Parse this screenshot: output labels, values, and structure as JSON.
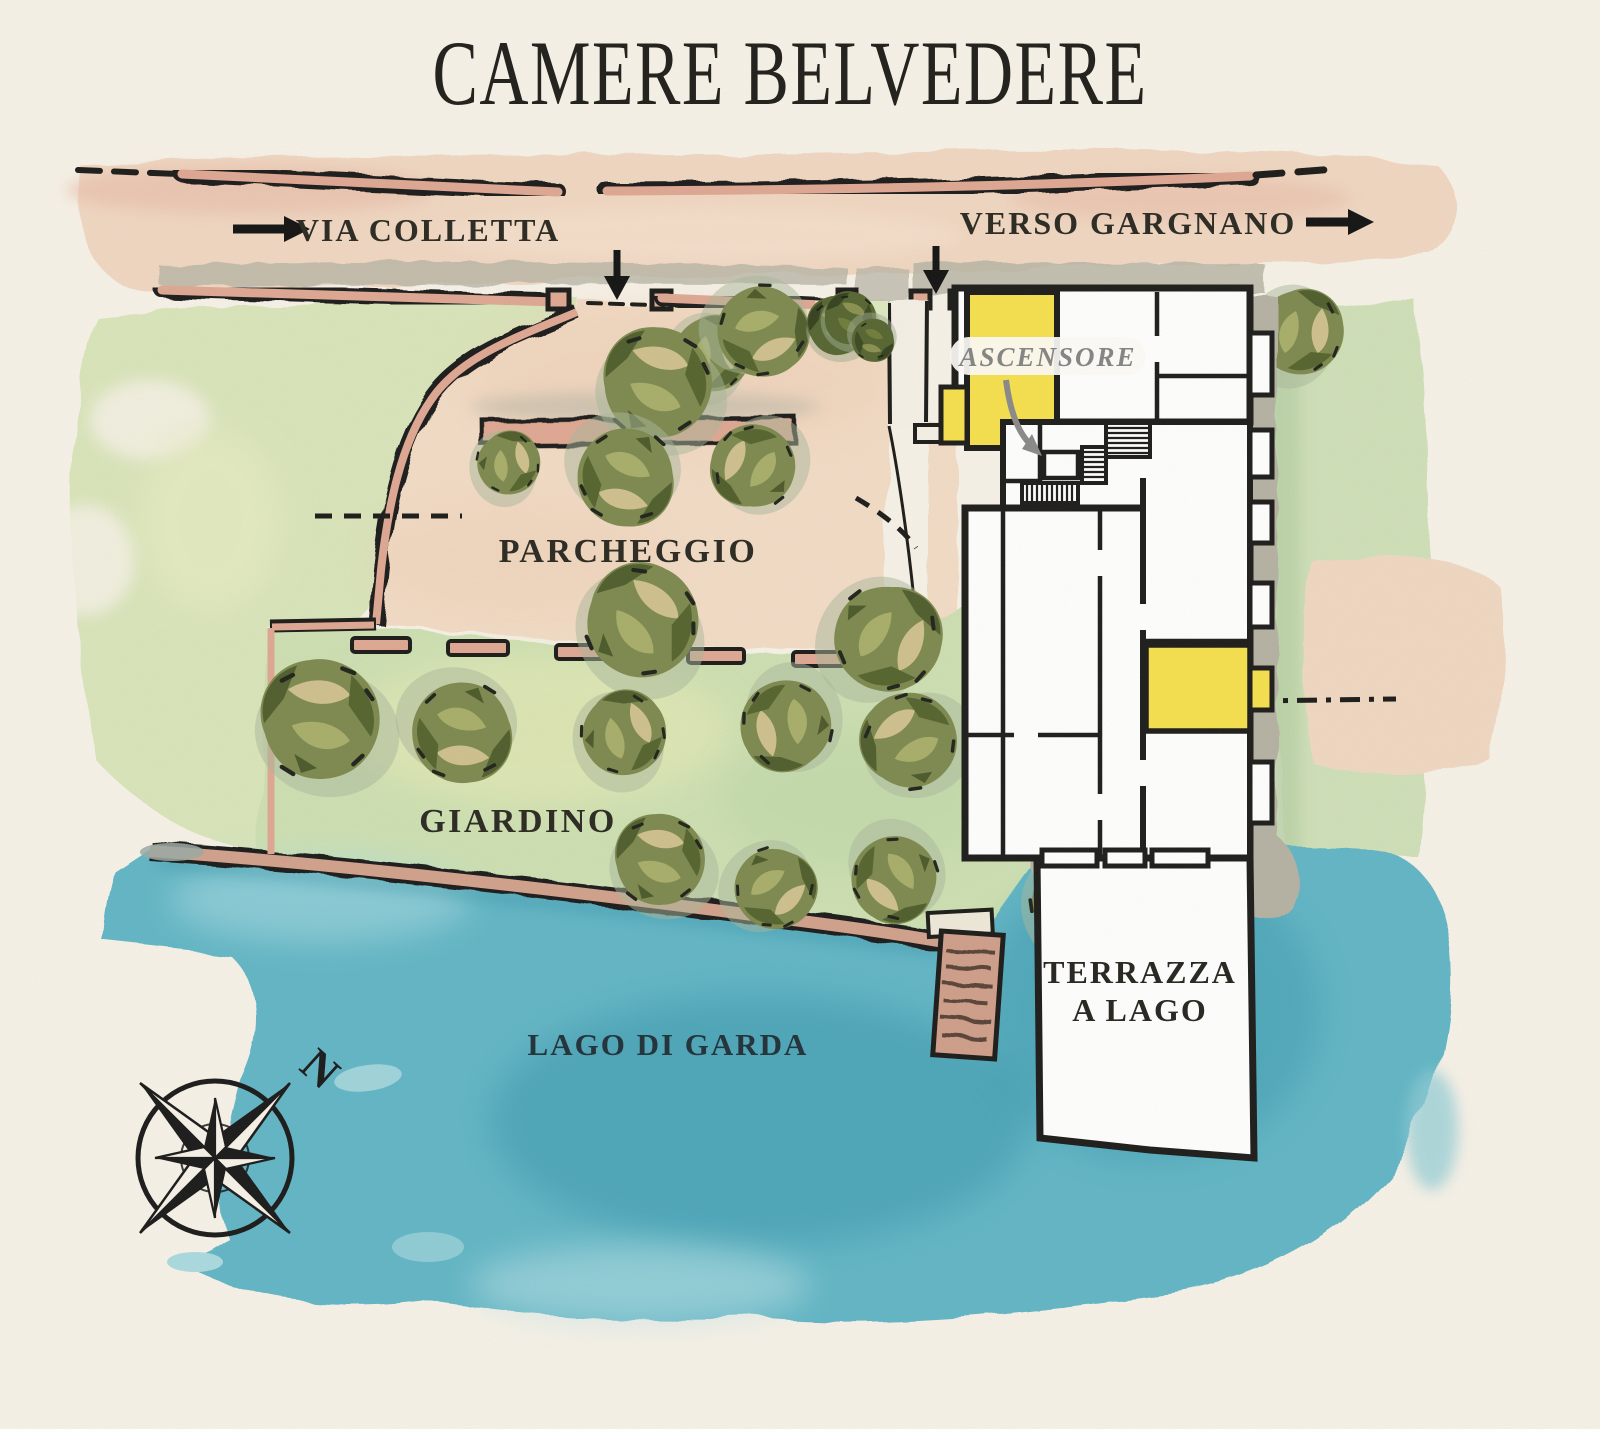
{
  "title": "CAMERE BELVEDERE",
  "map": {
    "streets": {
      "via_colletta": "VIA COLLETTA",
      "verso_gargnano": "VERSO GARGNANO"
    },
    "areas": {
      "parcheggio": "PARCHEGGIO",
      "giardino": "GIARDINO",
      "lago_di_garda": "LAGO DI GARDA",
      "terrazza_line1": "TERRAZZA",
      "terrazza_line2": "A LAGO"
    },
    "building": {
      "ascensore_label": "ASCENSORE"
    },
    "compass": {
      "north_label": "N"
    },
    "colors": {
      "paper": "#f7f2e8",
      "road_wash": "#f0d7c2",
      "wall_pink": "#dfa893",
      "parking_wash": "#f2dcc6",
      "garden_green": "#cde0b2",
      "tree_olive": "#7d8a4f",
      "water_teal": "#62b6c6",
      "building_ink": "#1d1d1b",
      "room_highlight_yellow": "#f6e04e",
      "gray_band": "#b5b2a3",
      "label_ink": "#2b2a22",
      "ascensore_gray": "#8a8a8a"
    }
  }
}
